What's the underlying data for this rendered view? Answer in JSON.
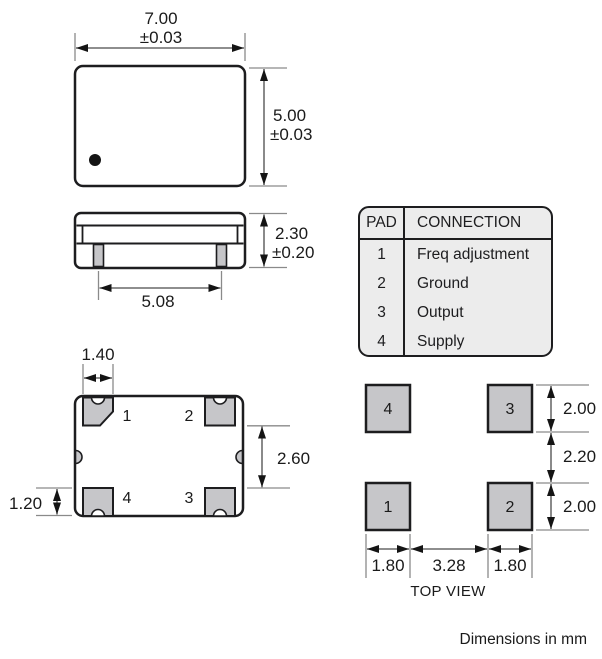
{
  "title_note": "Dimensions in mm",
  "package_top": {
    "width": "7.00",
    "width_tol": "±0.03",
    "height": "5.00",
    "height_tol": "±0.03"
  },
  "package_side": {
    "height": "2.30",
    "height_tol": "±0.20",
    "pad_span": "5.08"
  },
  "package_bottom": {
    "pad_width": "1.40",
    "pad_vgap": "2.60",
    "pad_height": "1.20",
    "pads": {
      "p1": "1",
      "p2": "2",
      "p3": "3",
      "p4": "4"
    }
  },
  "pad_table": {
    "header_pad": "PAD",
    "header_connection": "CONNECTION",
    "rows": [
      {
        "pad": "1",
        "connection": "Freq adjustment"
      },
      {
        "pad": "2",
        "connection": "Ground"
      },
      {
        "pad": "3",
        "connection": "Output"
      },
      {
        "pad": "4",
        "connection": "Supply"
      }
    ]
  },
  "land_pattern": {
    "caption": "TOP VIEW",
    "pads": {
      "p1": "1",
      "p2": "2",
      "p3": "3",
      "p4": "4"
    },
    "pad_height_top": "2.00",
    "row_gap": "2.20",
    "pad_height_bottom": "2.00",
    "pad_width_left": "1.80",
    "pad_gap": "3.28",
    "pad_width_right": "1.80"
  },
  "colors": {
    "line": "#1d1d1f",
    "pad_fill": "#c6c6c9",
    "table_fill": "#ececec",
    "extension_line": "#8a8a8a",
    "dimension_line": "#4a4a4a",
    "arrow": "#141414"
  }
}
